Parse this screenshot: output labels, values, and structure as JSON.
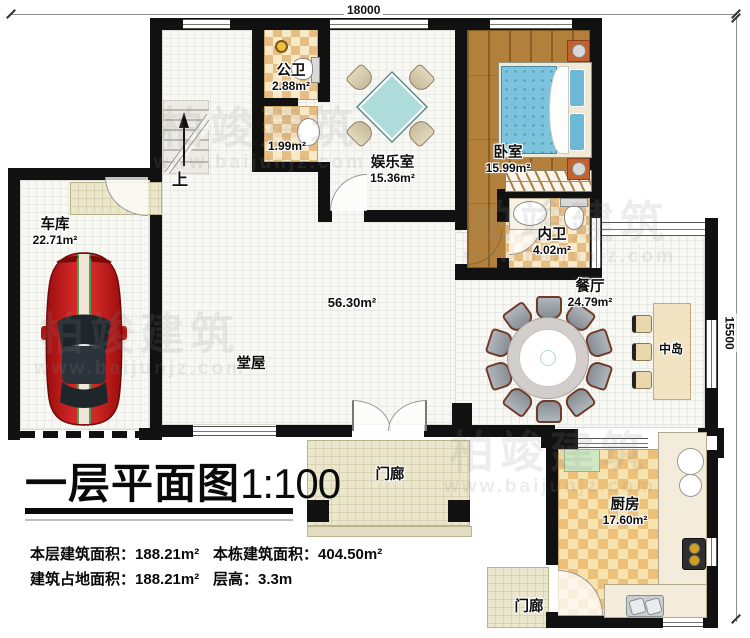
{
  "dimensions": {
    "top": "18000",
    "right": "15500"
  },
  "rooms": {
    "garage": {
      "name": "车库",
      "area": "22.71m²"
    },
    "public_bath": {
      "name": "公卫",
      "area": "2.88m²"
    },
    "washroom": {
      "area": "1.99m²"
    },
    "entertainment": {
      "name": "娱乐室",
      "area": "15.36m²"
    },
    "bedroom": {
      "name": "卧室",
      "area": "15.99m²"
    },
    "inner_bath": {
      "name": "内卫",
      "area": "4.02m²"
    },
    "dining": {
      "name": "餐厅",
      "area": "24.79m²"
    },
    "island": {
      "name": "中岛"
    },
    "hall": {
      "name": "堂屋",
      "area": "56.30m²"
    },
    "kitchen": {
      "name": "厨房",
      "area": "17.60m²"
    },
    "porch_front": {
      "name": "门廊"
    },
    "porch_side": {
      "name": "门廊"
    },
    "stairs": {
      "up_label": "上"
    }
  },
  "title": {
    "text": "一层平面图",
    "scale": "1:100"
  },
  "stats": {
    "floor_area": {
      "label": "本层建筑面积：",
      "value": "188.21m²"
    },
    "total_area": {
      "label": "本栋建筑面积：",
      "value": "404.50m²"
    },
    "footprint": {
      "label": "建筑占地面积：",
      "value": "188.21m²"
    },
    "story_height": {
      "label": "层高：",
      "value": "3.3m"
    }
  },
  "watermark": {
    "brand": "柏竣建筑",
    "url": "www.baijunjz.com"
  },
  "colors": {
    "wall": "#111111",
    "car_red": "#c41616",
    "bed_blue": "#7cc4dd",
    "checker_tan": "#e6bd82",
    "wood": "#b2803b"
  }
}
